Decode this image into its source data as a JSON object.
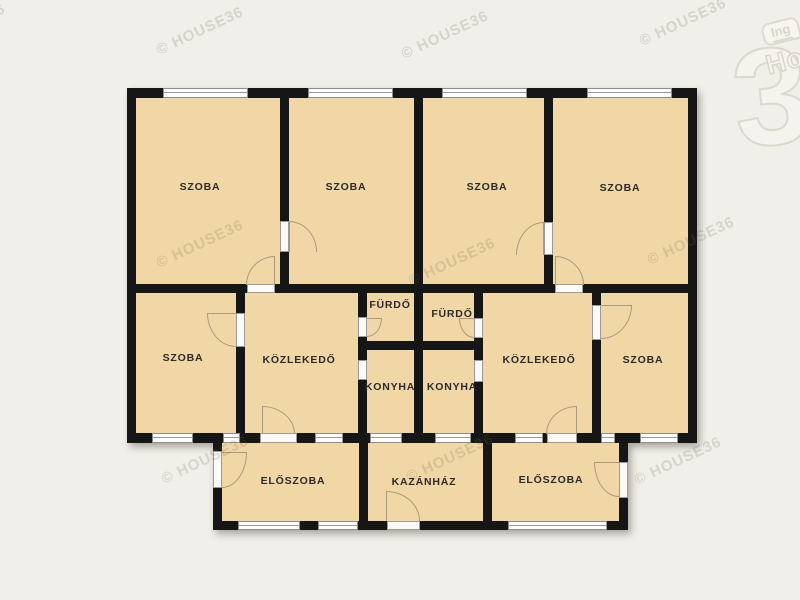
{
  "title": "floor-plan",
  "watermark": {
    "text": "© HOUSE36"
  },
  "logo": {
    "badge": "Ing",
    "name_fragment": "Ho",
    "number": "3"
  },
  "rooms": {
    "szoba_1": "SZOBA",
    "szoba_2": "SZOBA",
    "szoba_3": "SZOBA",
    "szoba_4": "SZOBA",
    "szoba_mid_left": "SZOBA",
    "kozlekedo_left": "KÖZLEKEDŐ",
    "furdo_left": "FÜRDŐ",
    "furdo_right": "FÜRDŐ",
    "konyha_left": "KONYHA",
    "konyha_right": "KONYHA",
    "kozlekedo_right": "KÖZLEKEDŐ",
    "szoba_mid_right": "SZOBA",
    "eloszoba_left": "ELŐSZOBA",
    "kazanhaz": "KAZÁNHÁZ",
    "eloszoba_right": "ELŐSZOBA"
  },
  "colors": {
    "background": "#f1efe9",
    "room_fill": "#f2d7a6",
    "wall": "#161616",
    "window": "#ffffff",
    "door_arc": "#a89a7e",
    "label_text": "#2b2b2b",
    "watermark_tint": "#696252"
  }
}
